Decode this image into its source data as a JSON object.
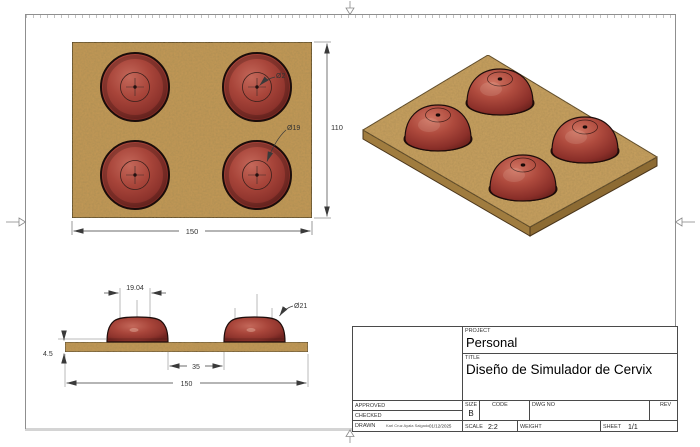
{
  "title_block": {
    "project": {
      "label": "PROJECT",
      "value": "Personal"
    },
    "title": {
      "label": "TITLE",
      "value": "Diseño de Simulador de Cervix"
    },
    "approved": {
      "label": "APPROVED"
    },
    "checked": {
      "label": "CHECKED"
    },
    "drawn": {
      "label": "DRAWN",
      "name": "Karl Cruz Ayala Salgado",
      "date": "01/12/2025"
    },
    "size": {
      "label": "SIZE",
      "value": "B"
    },
    "code": {
      "label": "CODE"
    },
    "dwg_no": {
      "label": "DWG NO"
    },
    "rev": {
      "label": "REV"
    },
    "scale": {
      "label": "SCALE",
      "value": "2:2"
    },
    "weight": {
      "label": "WEIGHT"
    },
    "sheet": {
      "label": "SHEET",
      "value": "1/1"
    }
  },
  "dimensions": {
    "top_view": {
      "hole_diameter": "Ø2",
      "inner_diameter": "Ø19",
      "board_height": "110",
      "board_width": "150"
    },
    "side_view": {
      "dome_top_width": "19.04",
      "dome_diameter": "Ø21",
      "board_thickness": "4.5",
      "dome_spacing": "35",
      "board_length": "150"
    }
  },
  "colors": {
    "board_tan": "#c49a57",
    "board_side": "#8d6b33",
    "dome_red": "#a8453a",
    "dome_highlight": "#c4685a",
    "outline": "#1e0d0b",
    "dimension_line": "#3a3a3a",
    "sheet_border": "#8f8f8f"
  }
}
